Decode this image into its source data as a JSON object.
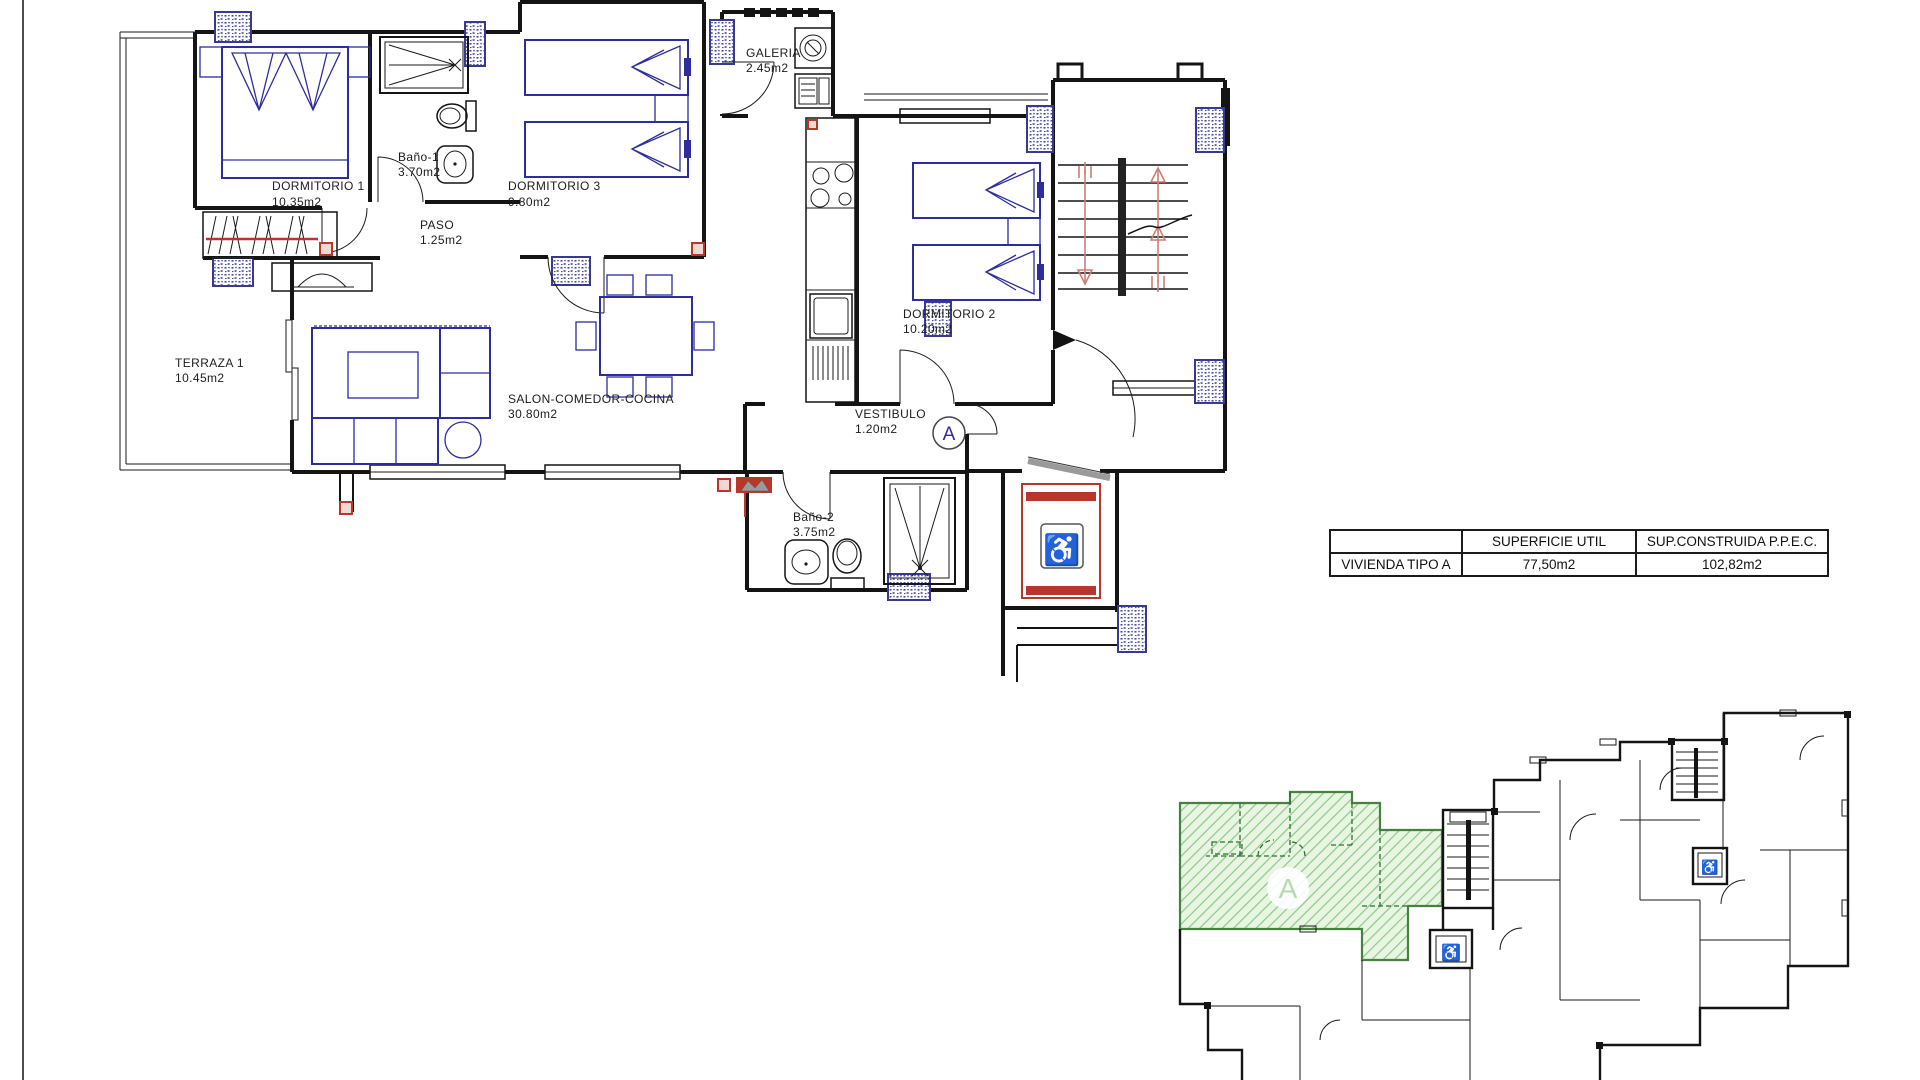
{
  "plan": {
    "unit_label": "A",
    "rooms": [
      {
        "name": "DORMITORIO 1",
        "area": "10.35m2"
      },
      {
        "name": "Baño-1",
        "area": "3.70m2"
      },
      {
        "name": "DORMITORIO 3",
        "area": "9.80m2"
      },
      {
        "name": "PASO",
        "area": "1.25m2"
      },
      {
        "name": "GALERIA",
        "area": "2.45m2"
      },
      {
        "name": "DORMITORIO 2",
        "area": "10.20m2"
      },
      {
        "name": "TERRAZA 1",
        "area": "10.45m2"
      },
      {
        "name": "SALON-COMEDOR-COCINA",
        "area": "30.80m2"
      },
      {
        "name": "VESTIBULO",
        "area": "1.20m2"
      },
      {
        "name": "Baño-2",
        "area": "3.75m2"
      }
    ],
    "accessible_icon": "♿"
  },
  "summary_table": {
    "headers": {
      "unit": "",
      "superficie_util": "SUPERFICIE UTIL",
      "sup_construida": "SUP.CONSTRUIDA  P.P.E.C."
    },
    "row": {
      "unit": "VIVIENDA  TIPO  A",
      "superficie_util": "77,50m2",
      "sup_construida": "102,82m2"
    }
  },
  "siteplan": {
    "unit_label": "A",
    "accessible_icon": "♿"
  },
  "colors": {
    "wall": "#141414",
    "furniture_blue": "#2d2d9e",
    "red_accent": "#b8372b",
    "stair_arrow": "#cf7d75",
    "highlight_green_fill": "#e9f5e3",
    "highlight_green_hatch": "#8cc984",
    "highlight_green_border": "#47813f"
  }
}
